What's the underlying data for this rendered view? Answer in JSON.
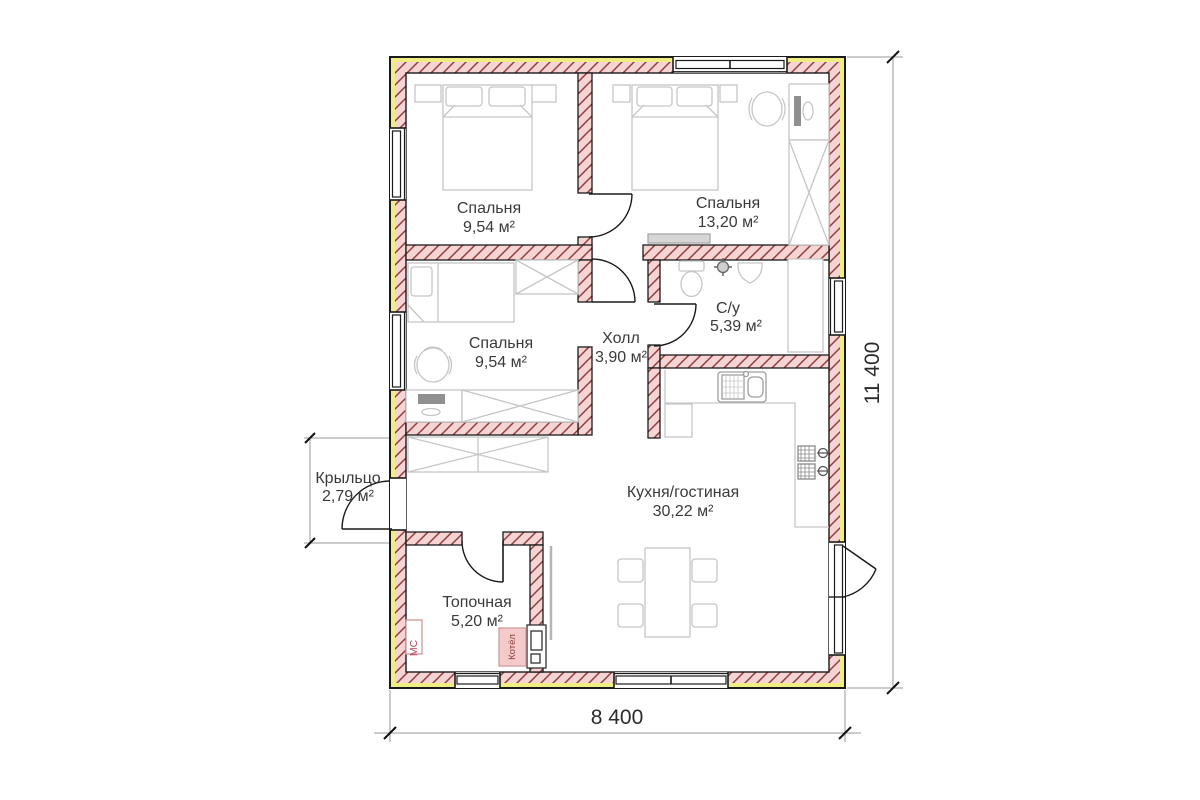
{
  "rooms": {
    "bedroom_top_left": {
      "name": "Спальня",
      "area": "9,54 м²"
    },
    "bedroom_top_right": {
      "name": "Спальня",
      "area": "13,20 м²"
    },
    "bedroom_middle": {
      "name": "Спальня",
      "area": "9,54 м²"
    },
    "hall": {
      "name": "Холл",
      "area": "3,90 м²"
    },
    "bathroom": {
      "name": "С/у",
      "area": "5,39 м²"
    },
    "kitchen_living": {
      "name": "Кухня/гостиная",
      "area": "30,22 м²"
    },
    "boiler_room": {
      "name": "Топочная",
      "area": "5,20 м²"
    },
    "porch": {
      "name": "Крыльцо",
      "area": "2,79 м²"
    }
  },
  "dimensions": {
    "overall_width": "8 400",
    "overall_height": "11 400"
  },
  "equipment_labels": {
    "boiler": "Котёл",
    "meter_cabinet": "МС"
  },
  "colors": {
    "wall_fill": "#f7d4d4",
    "wall_hatch": "#8f3e3e",
    "insulation_band": "#f0ee82",
    "outline": "#1a1a1a",
    "furniture": "#c6c6c6",
    "dimension_line": "#999999",
    "text": "#3a3a3a"
  }
}
